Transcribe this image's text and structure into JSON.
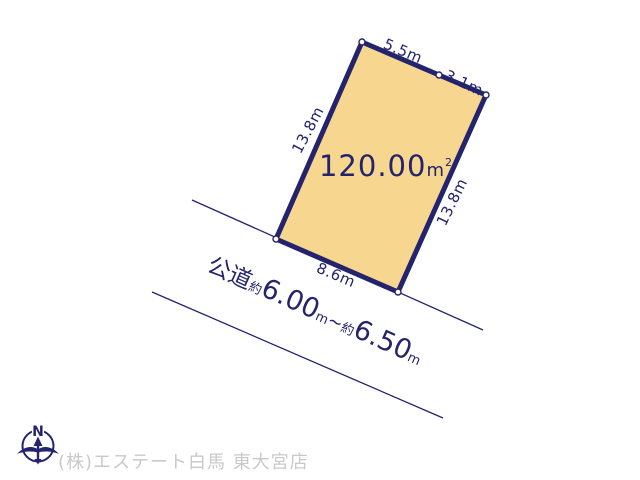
{
  "canvas": {
    "width": "640",
    "height": "480",
    "background": "#ffffff"
  },
  "plot": {
    "area_value": "120.00",
    "area_unit_base": "m",
    "area_unit_exponent": "2",
    "fill_color": "#f7d78f",
    "outline_color": "#23236e",
    "edges": [
      {
        "side": "top-left",
        "length_label": "5.5m"
      },
      {
        "side": "top-right",
        "length_label": "3.1m"
      },
      {
        "side": "left",
        "length_label": "13.8m"
      },
      {
        "side": "right",
        "length_label": "13.8m"
      },
      {
        "side": "bottom",
        "length_label": "8.6m"
      }
    ]
  },
  "road": {
    "type_label": "公道",
    "approx_label_min": "約",
    "width_min": "6.00",
    "unit_min": "m",
    "range_separator": "~",
    "approx_label_max": "約",
    "width_max": "6.50",
    "unit_max": "m"
  },
  "compass": {
    "north_label": "N"
  },
  "footer": {
    "company_name": "(株)エステート白馬 東大宮店",
    "text_color": "#c9c9c9"
  }
}
